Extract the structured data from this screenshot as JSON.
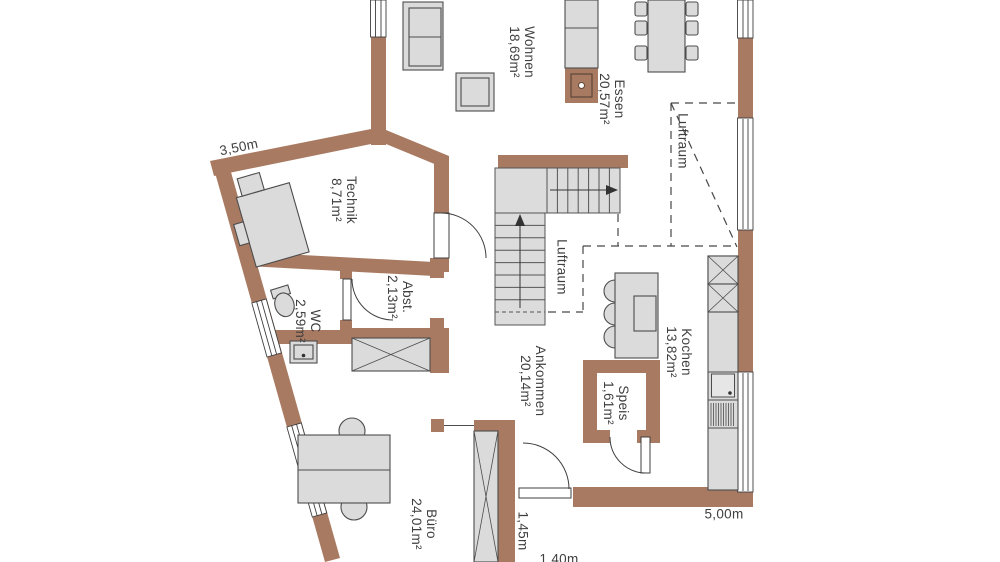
{
  "colors": {
    "wall_fill": "#A97A62",
    "furniture_fill": "#DBDBDB",
    "stair_fill": "#DCDCDC",
    "background": "#FFFFFF",
    "text": "#3F3F3F"
  },
  "rooms": {
    "wohnen": {
      "name": "Wohnen",
      "area": "18,69m²"
    },
    "essen": {
      "name": "Essen",
      "area": "20,57m²"
    },
    "luftraum_gross": {
      "name": "Luftraum"
    },
    "luftraum_klein": {
      "name": "Luftraum"
    },
    "technik": {
      "name": "Technik",
      "area": "8,71m²"
    },
    "wc": {
      "name": "WC",
      "area": "2,59m²"
    },
    "abst": {
      "name": "Abst.",
      "area": "2,13m²"
    },
    "kochen": {
      "name": "Kochen",
      "area": "13,82m²"
    },
    "ankommen": {
      "name": "Ankommen",
      "area": "20,14m²"
    },
    "speis": {
      "name": "Speis",
      "area": "1,61m²"
    },
    "buero": {
      "name": "Büro",
      "area": "24,01m²"
    }
  },
  "dimensions": {
    "top_left_wall": "3,50m",
    "bottom_right_wall": "5,00m",
    "entrance_door": "1,45m",
    "bottom_edge": "1,40m"
  }
}
